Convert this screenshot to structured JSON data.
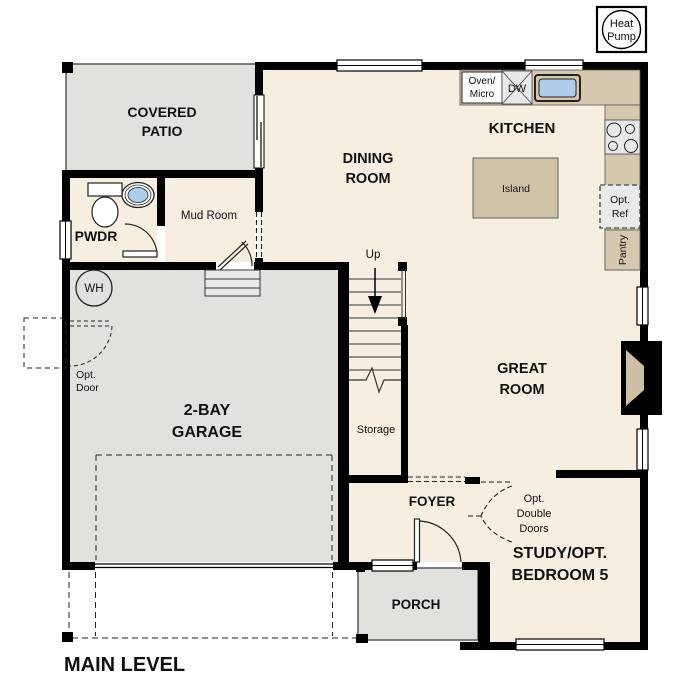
{
  "title": "MAIN LEVEL",
  "colors": {
    "floor": "#f6eee1",
    "outdoor": "#e1e1de",
    "wall": "#000000",
    "counter": "#d5c8ae",
    "island": "#cfc2a6",
    "firebox": "#cdbfa4",
    "sink_blue": "#aecdeb",
    "appliance_gray": "#e9e9e9",
    "opt_ref_gray": "#e7e9ea",
    "white": "#ffffff"
  },
  "rooms": {
    "covered_patio": {
      "line1": "COVERED",
      "line2": "PATIO"
    },
    "pwdr": {
      "label": "PWDR"
    },
    "mud_room": {
      "label": "Mud Room"
    },
    "dining": {
      "line1": "DINING",
      "line2": "ROOM"
    },
    "kitchen": {
      "label": "KITCHEN"
    },
    "great_room": {
      "line1": "GREAT",
      "line2": "ROOM"
    },
    "garage": {
      "line1": "2-BAY",
      "line2": "GARAGE"
    },
    "foyer": {
      "label": "FOYER"
    },
    "porch": {
      "label": "PORCH"
    },
    "study": {
      "line1": "STUDY/OPT.",
      "line2": "BEDROOM 5"
    },
    "storage": {
      "label": "Storage"
    }
  },
  "features": {
    "heat_pump": {
      "line1": "Heat",
      "line2": "Pump"
    },
    "island": {
      "label": "Island"
    },
    "oven_micro": {
      "line1": "Oven/",
      "line2": "Micro"
    },
    "dishwasher": {
      "label": "DW"
    },
    "opt_ref": {
      "line1": "Opt.",
      "line2": "Ref"
    },
    "pantry": {
      "label": "Pantry"
    },
    "water_heater": {
      "label": "WH"
    },
    "stairs_up": {
      "label": "Up"
    },
    "opt_door": {
      "line1": "Opt.",
      "line2": "Door"
    },
    "opt_double_doors": {
      "line1": "Opt.",
      "line2": "Double",
      "line3": "Doors"
    }
  }
}
